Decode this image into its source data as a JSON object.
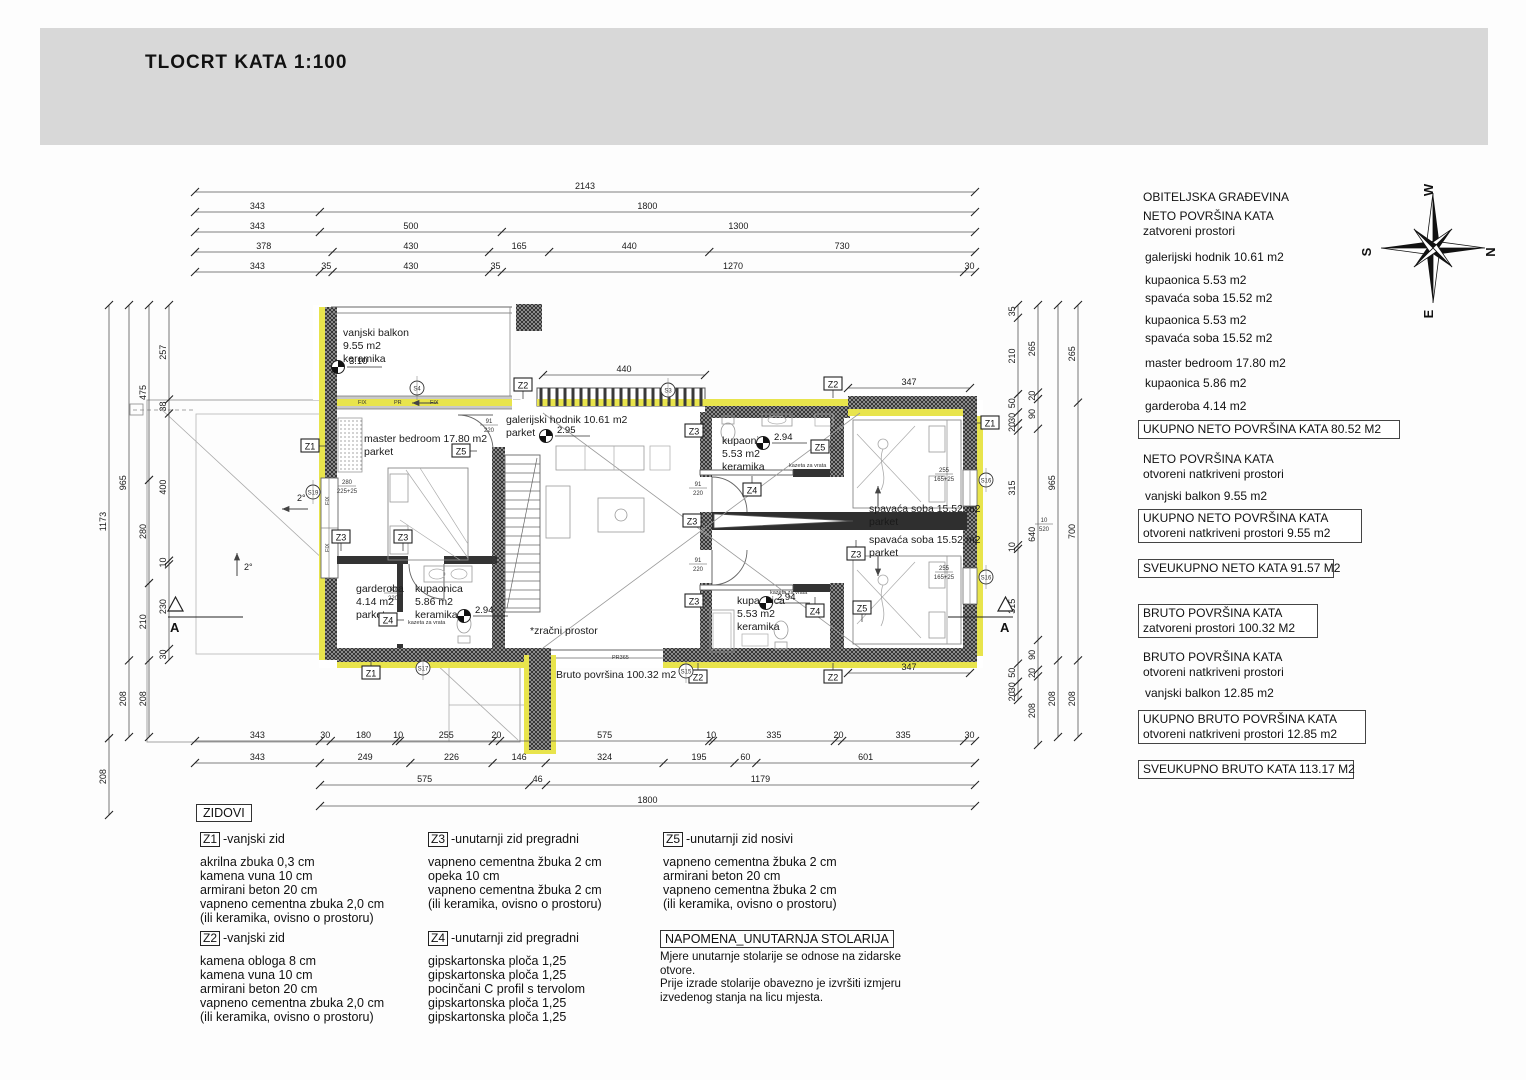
{
  "title": "TLOCRT KATA  1:100",
  "colors": {
    "band": "#d8d8d8",
    "insulation": "#e8e44c",
    "wall_hatch_bg": "#adadad",
    "line": "#444444"
  },
  "compass": {
    "top": "W",
    "right": "N",
    "bottom": "E",
    "left": "S"
  },
  "right_panel": {
    "title": "OBITELJSKA GRAĐEVINA",
    "neto_heading": "NETO  POVRŠINA KATA",
    "neto_sub": "zatvoreni prostori",
    "rooms": [
      "galerijski hodnik 10.61 m2",
      "kupaonica  5.53 m2",
      "spavaća soba 15.52 m2",
      "kupaonica  5.53 m2",
      "spavaća soba 15.52 m2",
      "master bedroom  17.80 m2",
      "kupaonica 5.86 m2",
      "garderoba 4.14 m2"
    ],
    "box_neto_total": "UKUPNO  NETO  POVRŠINA KATA 80.52  M2",
    "neto_open_heading": "NETO  POVRŠINA KATA",
    "neto_open_sub": "otvoreni natkriveni prostori",
    "neto_open_item": "vanjski balkon  9.55 m2",
    "box_neto_open_1": "UKUPNO NETO  POVRŠINA KATA",
    "box_neto_open_2": "otvoreni natkriveni prostori   9.55 m2",
    "box_sveukupno_neto": "SVEUKUPNO NETO KATA  91.57 M2",
    "box_bruto_1": "BRUTO POVRŠINA KATA",
    "box_bruto_2": "zatvoreni prostori  100.32 M2",
    "bruto_open_heading": "BRUTO  POVRŠINA KATA",
    "bruto_open_sub": "otvoreni natkriveni prostori",
    "bruto_open_item": "vanjski balkon  12.85 m2",
    "box_bruto_open_1": "UKUPNO BRUTO POVRŠINA KATA",
    "box_bruto_open_2": "otvoreni natkriveni prostori   12.85 m2",
    "box_sveukupno_bruto": "SVEUKUPNO BRUTO  KATA   113.17 M2"
  },
  "legend": {
    "title": "ZIDOVI",
    "entries": [
      {
        "code": "Z1",
        "name": "-vanjski zid",
        "layers": [
          "akrilna zbuka 0,3 cm",
          "kamena vuna 10 cm",
          "armirani beton 20 cm",
          "vapneno cementna zbuka 2,0 cm",
          "(ili keramika, ovisno o prostoru)"
        ]
      },
      {
        "code": "Z2",
        "name": "-vanjski zid",
        "layers": [
          "kamena obloga 8 cm",
          "kamena vuna 10 cm",
          "armirani beton 20 cm",
          "vapneno cementna zbuka 2,0 cm",
          "(ili keramika, ovisno o prostoru)"
        ]
      },
      {
        "code": "Z3",
        "name": "-unutarnji zid pregradni",
        "layers": [
          "vapneno cementna žbuka 2 cm",
          "opeka 10 cm",
          "vapneno cementna žbuka 2 cm",
          "(ili keramika, ovisno o prostoru)"
        ]
      },
      {
        "code": "Z4",
        "name": "-unutarnji zid pregradni",
        "layers": [
          "gipskartonska ploča 1,25",
          "gipskartonska ploča 1,25",
          "pocinčani C profil s tervolom",
          "gipskartonska ploča 1,25",
          "gipskartonska ploča 1,25"
        ]
      },
      {
        "code": "Z5",
        "name": "-unutarnji zid nosivi",
        "layers": [
          "vapneno cementna žbuka 2 cm",
          "armirani beton 20 cm",
          "vapneno cementna žbuka 2 cm",
          "(ili keramika, ovisno o prostoru)"
        ]
      }
    ],
    "napomena_title": "NAPOMENA_UNUTARNJA STOLARIJA",
    "napomena_lines": [
      "Mjere unutarnje stolarije se odnose na zidarske",
      "otvore.",
      "Prije izrade stolarije obavezno je izvršiti izmjeru",
      "izvedenog stanja na licu mjesta."
    ]
  },
  "dims": {
    "top": [
      [
        "2143"
      ],
      [
        "343",
        "1800"
      ],
      [
        "343",
        "500",
        "1300"
      ],
      [
        "378",
        "430",
        "165",
        "440",
        "730"
      ],
      [
        "343",
        "35",
        "430",
        "35",
        "1270",
        "30"
      ]
    ],
    "bottom": [
      [
        "343",
        "30",
        "180",
        "10",
        "255",
        "20",
        "575",
        "10",
        "335",
        "20",
        "335",
        "30"
      ],
      [
        "343",
        "249",
        "226",
        "146",
        "324",
        "195",
        "60",
        "601"
      ],
      [
        "575",
        "46",
        "1179"
      ],
      [
        "1800"
      ]
    ],
    "left": [
      [
        "1173",
        "208"
      ],
      [
        "965",
        "208"
      ],
      [
        "475",
        "280",
        "210",
        "208"
      ],
      [
        "257",
        "38",
        "400",
        "10",
        "230",
        "30"
      ]
    ],
    "right": [
      [
        "35",
        "210",
        "50",
        "30",
        "20",
        "315",
        "10",
        "315",
        "50",
        "30",
        "20"
      ],
      [
        "265",
        "20",
        "90",
        "640",
        "90",
        "20",
        "208"
      ],
      [
        "965",
        "208"
      ],
      [
        "265",
        "700",
        "208"
      ]
    ],
    "plan": [
      {
        "t": "440",
        "x0": 543,
        "x1": 705,
        "y": 375
      },
      {
        "t": "347",
        "x0": 848,
        "x1": 970,
        "y": 388
      },
      {
        "t": "347",
        "x0": 848,
        "x1": 970,
        "y": 673
      }
    ]
  },
  "plan": {
    "labels": [
      {
        "t": "vanjski balkon",
        "x": 343,
        "y": 336
      },
      {
        "t": "9.55 m2",
        "x": 343,
        "y": 349
      },
      {
        "t": "keramika",
        "x": 343,
        "y": 362
      },
      {
        "t": "master bedroom  17.80 m2",
        "x": 364,
        "y": 442
      },
      {
        "t": "parket",
        "x": 364,
        "y": 455
      },
      {
        "t": "galerijski hodnik 10.61 m2",
        "x": 506,
        "y": 423
      },
      {
        "t": "parket",
        "x": 506,
        "y": 436
      },
      {
        "t": "kupaonica",
        "x": 722,
        "y": 444
      },
      {
        "t": "5.53 m2",
        "x": 722,
        "y": 457
      },
      {
        "t": "keramika",
        "x": 722,
        "y": 470
      },
      {
        "t": "spavaća soba 15.52 m2",
        "x": 869,
        "y": 512
      },
      {
        "t": "parket",
        "x": 869,
        "y": 525
      },
      {
        "t": "spavaća soba 15.52 m2",
        "x": 869,
        "y": 543
      },
      {
        "t": "parket",
        "x": 869,
        "y": 556
      },
      {
        "t": "kupaonica",
        "x": 737,
        "y": 604
      },
      {
        "t": "5.53 m2",
        "x": 737,
        "y": 617
      },
      {
        "t": "keramika",
        "x": 737,
        "y": 630
      },
      {
        "t": "garderoba",
        "x": 356,
        "y": 592
      },
      {
        "t": "4.14 m2",
        "x": 356,
        "y": 605
      },
      {
        "t": "parket",
        "x": 356,
        "y": 618
      },
      {
        "t": "kupaonica",
        "x": 415,
        "y": 592
      },
      {
        "t": "5.86 m2",
        "x": 415,
        "y": 605
      },
      {
        "t": "keramika",
        "x": 415,
        "y": 618
      },
      {
        "t": "*zračni prostor",
        "x": 530,
        "y": 634
      },
      {
        "t": "Bruto površina 100.32 m2",
        "x": 556,
        "y": 678
      }
    ],
    "tiny": [
      {
        "t": "kazeta za vrata",
        "x": 789,
        "y": 467
      },
      {
        "t": "kazeta za vrata",
        "x": 770,
        "y": 594
      },
      {
        "t": "kazeta za vrata",
        "x": 408,
        "y": 624
      },
      {
        "t": "FIX",
        "x": 358,
        "y": 404
      },
      {
        "t": "PR",
        "x": 394,
        "y": 404
      },
      {
        "t": "FIX",
        "x": 430,
        "y": 404
      },
      {
        "t": "FIX",
        "x": 329,
        "y": 505,
        "r": -90
      },
      {
        "t": "FIX",
        "x": 329,
        "y": 552,
        "r": -90
      },
      {
        "t": "PR365",
        "x": 612,
        "y": 659
      }
    ],
    "fractions": [
      {
        "a": "91",
        "b": "220",
        "x": 698,
        "y": 487
      },
      {
        "a": "91",
        "b": "220",
        "x": 698,
        "y": 563
      },
      {
        "a": "91",
        "b": "220",
        "x": 489,
        "y": 424
      },
      {
        "a": "80",
        "b": "220",
        "x": 393,
        "y": 592
      },
      {
        "a": "255",
        "b": "165+25",
        "x": 944,
        "y": 473
      },
      {
        "a": "255",
        "b": "165+25",
        "x": 944,
        "y": 571
      },
      {
        "a": "280",
        "b": "225+25",
        "x": 347,
        "y": 485
      },
      {
        "a": "10",
        "b": "520",
        "x": 1044,
        "y": 523
      }
    ],
    "markers": [
      {
        "t": "Z1",
        "x": 310,
        "y": 446,
        "d": "e"
      },
      {
        "t": "Z1",
        "x": 371,
        "y": 673,
        "d": "n"
      },
      {
        "t": "Z1",
        "x": 990,
        "y": 423,
        "d": "w"
      },
      {
        "t": "Z2",
        "x": 523,
        "y": 385,
        "d": "s"
      },
      {
        "t": "Z2",
        "x": 833,
        "y": 384,
        "d": "s"
      },
      {
        "t": "Z2",
        "x": 698,
        "y": 677,
        "d": "n"
      },
      {
        "t": "Z2",
        "x": 833,
        "y": 677,
        "d": "n"
      },
      {
        "t": "Z3",
        "x": 341,
        "y": 537,
        "d": "s"
      },
      {
        "t": "Z3",
        "x": 403,
        "y": 537,
        "d": "s"
      },
      {
        "t": "Z3",
        "x": 694,
        "y": 431,
        "d": "e"
      },
      {
        "t": "Z3",
        "x": 692,
        "y": 521,
        "d": "e"
      },
      {
        "t": "Z3",
        "x": 856,
        "y": 554,
        "d": "n"
      },
      {
        "t": "Z3",
        "x": 694,
        "y": 601,
        "d": "e"
      },
      {
        "t": "Z4",
        "x": 752,
        "y": 490,
        "d": "n"
      },
      {
        "t": "Z4",
        "x": 388,
        "y": 620,
        "d": "e"
      },
      {
        "t": "Z4",
        "x": 815,
        "y": 611,
        "d": "n"
      },
      {
        "t": "Z5",
        "x": 461,
        "y": 451,
        "d": "e"
      },
      {
        "t": "Z5",
        "x": 820,
        "y": 447,
        "d": "e"
      },
      {
        "t": "Z5",
        "x": 862,
        "y": 608,
        "d": "s"
      }
    ],
    "circles": [
      {
        "t": "S4",
        "x": 417,
        "y": 388
      },
      {
        "t": "S3",
        "x": 668,
        "y": 390
      },
      {
        "t": "S19",
        "x": 313,
        "y": 492
      },
      {
        "t": "S17",
        "x": 423,
        "y": 668
      },
      {
        "t": "S15",
        "x": 686,
        "y": 671
      },
      {
        "t": "S16",
        "x": 986,
        "y": 480
      },
      {
        "t": "S16",
        "x": 986,
        "y": 577
      }
    ],
    "levels": [
      {
        "v": "3.10",
        "x": 338,
        "y": 367
      },
      {
        "v": "2.95",
        "x": 546,
        "y": 436
      },
      {
        "v": "2.94",
        "x": 763,
        "y": 443
      },
      {
        "v": "2.94",
        "x": 464,
        "y": 616
      },
      {
        "v": "2.94",
        "x": 766,
        "y": 603
      }
    ],
    "section_label": "A",
    "slope_label": "2°"
  }
}
